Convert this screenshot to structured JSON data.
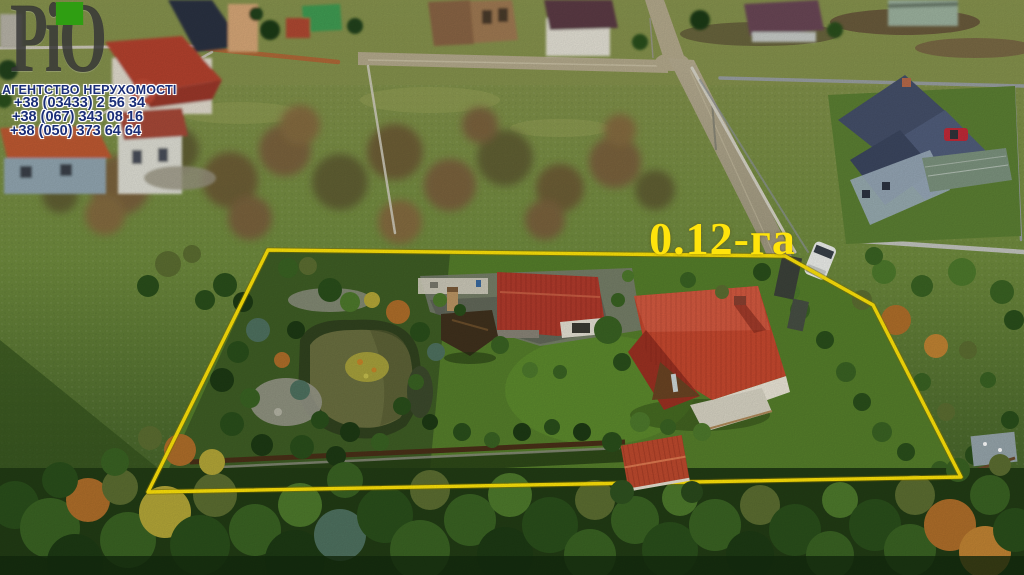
{
  "image": {
    "kind": "aerial-drone-photo",
    "description": "Aerial view of a fenced landscaped plot with houses, pond and gardens, outlined in yellow"
  },
  "watermark": {
    "logo_text": "РіО",
    "agency_line": "АГЕНТСТВО НЕРУХОМОСТІ",
    "phones": [
      "+38 (03433) 2 56 34",
      "+38 (067) 343 08 16",
      "+38 (050) 373 64 64"
    ],
    "colors": {
      "text": "#1b2f78",
      "outline": "#ffffff",
      "logo": "#2f2f2f",
      "logo_accent": "#2f9e12"
    }
  },
  "overlay": {
    "area_label": "0.12-га",
    "boundary_color": "#ffe409",
    "boundary_points": "268,250 785,256 873,305 961,477 148,492"
  },
  "scene": {
    "palette": [
      "#1d3a14",
      "#2a4f1b",
      "#3a6323",
      "#4e7a2c",
      "#6f8f3f",
      "#5c6e31",
      "#b06f2a",
      "#c28433",
      "#b5a838",
      "#4f7260"
    ],
    "scrub_palette": [
      "#6d5a36",
      "#7b5f3e",
      "#5f5c32",
      "#87693f"
    ],
    "scrub": [
      [
        70,
        160,
        26,
        0
      ],
      [
        120,
        185,
        30,
        1
      ],
      [
        175,
        150,
        24,
        2
      ],
      [
        230,
        180,
        28,
        0
      ],
      [
        285,
        150,
        26,
        1
      ],
      [
        340,
        182,
        28,
        2
      ],
      [
        395,
        152,
        28,
        0
      ],
      [
        450,
        185,
        26,
        1
      ],
      [
        505,
        158,
        28,
        2
      ],
      [
        560,
        188,
        24,
        0
      ],
      [
        615,
        162,
        26,
        1
      ],
      [
        655,
        190,
        20,
        2
      ],
      [
        105,
        215,
        20,
        3
      ],
      [
        250,
        218,
        22,
        1
      ],
      [
        400,
        222,
        22,
        3
      ],
      [
        545,
        220,
        20,
        1
      ],
      [
        300,
        125,
        20,
        3
      ],
      [
        480,
        125,
        18,
        1
      ],
      [
        620,
        130,
        16,
        3
      ],
      [
        60,
        195,
        18,
        2
      ]
    ],
    "trees_plot": [
      [
        168,
        264,
        13,
        5
      ],
      [
        148,
        286,
        11,
        1
      ],
      [
        192,
        254,
        9,
        5
      ],
      [
        205,
        300,
        10,
        1
      ],
      [
        225,
        285,
        12,
        1
      ],
      [
        243,
        302,
        10,
        0
      ],
      [
        258,
        330,
        12,
        9
      ],
      [
        238,
        352,
        11,
        1
      ],
      [
        222,
        380,
        12,
        0
      ],
      [
        250,
        398,
        10,
        2
      ],
      [
        232,
        424,
        12,
        1
      ],
      [
        262,
        445,
        11,
        0
      ],
      [
        288,
        268,
        10,
        2
      ],
      [
        308,
        266,
        9,
        5
      ],
      [
        330,
        290,
        12,
        1
      ],
      [
        350,
        302,
        10,
        3
      ],
      [
        296,
        330,
        9,
        0
      ],
      [
        282,
        360,
        8,
        6
      ],
      [
        300,
        390,
        10,
        9
      ],
      [
        320,
        420,
        9,
        1
      ],
      [
        350,
        432,
        10,
        0
      ],
      [
        380,
        442,
        9,
        2
      ],
      [
        302,
        447,
        12,
        1
      ],
      [
        336,
        456,
        10,
        0
      ],
      [
        372,
        300,
        8,
        8
      ],
      [
        398,
        312,
        12,
        6
      ],
      [
        420,
        332,
        10,
        1
      ],
      [
        436,
        352,
        9,
        9
      ],
      [
        416,
        382,
        8,
        2
      ],
      [
        402,
        406,
        9,
        1
      ],
      [
        430,
        422,
        8,
        0
      ],
      [
        462,
        432,
        9,
        1
      ],
      [
        492,
        440,
        8,
        2
      ],
      [
        522,
        432,
        9,
        0
      ],
      [
        552,
        427,
        8,
        1
      ],
      [
        582,
        432,
        9,
        0
      ],
      [
        608,
        330,
        14,
        2
      ],
      [
        622,
        362,
        9,
        1
      ],
      [
        640,
        422,
        10,
        3
      ],
      [
        668,
        427,
        8,
        2
      ],
      [
        612,
        442,
        10,
        1
      ],
      [
        702,
        432,
        9,
        3
      ],
      [
        688,
        280,
        8,
        2
      ],
      [
        722,
        292,
        7,
        5
      ],
      [
        762,
        272,
        9,
        1
      ],
      [
        800,
        310,
        10,
        2
      ],
      [
        825,
        340,
        9,
        1
      ],
      [
        846,
        372,
        10,
        2
      ],
      [
        862,
        402,
        9,
        1
      ],
      [
        882,
        432,
        10,
        2
      ],
      [
        906,
        452,
        9,
        1
      ],
      [
        896,
        320,
        15,
        6
      ],
      [
        936,
        346,
        12,
        7
      ],
      [
        922,
        382,
        9,
        2
      ],
      [
        946,
        412,
        9,
        5
      ],
      [
        862,
        300,
        10,
        5
      ],
      [
        792,
        292,
        8,
        3
      ],
      [
        884,
        272,
        12,
        3
      ],
      [
        922,
        286,
        11,
        2
      ],
      [
        962,
        272,
        14,
        3
      ],
      [
        1002,
        292,
        12,
        2
      ],
      [
        874,
        256,
        9,
        2
      ],
      [
        1014,
        320,
        10,
        1
      ],
      [
        968,
        350,
        9,
        5
      ],
      [
        988,
        380,
        8,
        2
      ],
      [
        1010,
        420,
        9,
        1
      ],
      [
        975,
        455,
        10,
        1
      ],
      [
        940,
        470,
        9,
        2
      ],
      [
        440,
        300,
        7,
        3
      ],
      [
        460,
        310,
        6,
        1
      ],
      [
        618,
        300,
        7,
        2
      ],
      [
        628,
        276,
        6,
        3
      ],
      [
        500,
        345,
        9,
        2
      ],
      [
        530,
        370,
        8,
        3
      ],
      [
        560,
        372,
        7,
        2
      ]
    ],
    "trees_bottom": [
      [
        15,
        505,
        24,
        1
      ],
      [
        50,
        528,
        30,
        2
      ],
      [
        88,
        500,
        22,
        6
      ],
      [
        75,
        562,
        28,
        0
      ],
      [
        128,
        540,
        28,
        2
      ],
      [
        120,
        487,
        18,
        5
      ],
      [
        165,
        512,
        26,
        8
      ],
      [
        200,
        545,
        30,
        1
      ],
      [
        215,
        495,
        22,
        5
      ],
      [
        255,
        530,
        26,
        2
      ],
      [
        295,
        560,
        30,
        0
      ],
      [
        300,
        505,
        22,
        3
      ],
      [
        340,
        535,
        26,
        9
      ],
      [
        345,
        480,
        18,
        2
      ],
      [
        385,
        515,
        28,
        1
      ],
      [
        420,
        550,
        30,
        2
      ],
      [
        430,
        490,
        20,
        5
      ],
      [
        470,
        520,
        26,
        2
      ],
      [
        505,
        555,
        28,
        0
      ],
      [
        510,
        495,
        22,
        3
      ],
      [
        550,
        525,
        28,
        1
      ],
      [
        590,
        555,
        26,
        2
      ],
      [
        595,
        500,
        20,
        5
      ],
      [
        635,
        520,
        24,
        2
      ],
      [
        670,
        550,
        28,
        1
      ],
      [
        680,
        498,
        18,
        3
      ],
      [
        715,
        525,
        26,
        2
      ],
      [
        750,
        555,
        24,
        0
      ],
      [
        760,
        505,
        20,
        5
      ],
      [
        795,
        530,
        26,
        1
      ],
      [
        830,
        555,
        24,
        2
      ],
      [
        840,
        500,
        18,
        3
      ],
      [
        875,
        525,
        26,
        1
      ],
      [
        910,
        550,
        26,
        2
      ],
      [
        915,
        495,
        20,
        5
      ],
      [
        950,
        525,
        26,
        6
      ],
      [
        985,
        552,
        26,
        7
      ],
      [
        990,
        495,
        20,
        2
      ],
      [
        1015,
        530,
        22,
        1
      ],
      [
        180,
        450,
        16,
        6
      ],
      [
        212,
        462,
        13,
        8
      ],
      [
        150,
        438,
        12,
        5
      ],
      [
        115,
        462,
        14,
        2
      ],
      [
        60,
        480,
        18,
        1
      ],
      [
        958,
        470,
        12,
        2
      ],
      [
        1000,
        465,
        11,
        5
      ]
    ]
  }
}
